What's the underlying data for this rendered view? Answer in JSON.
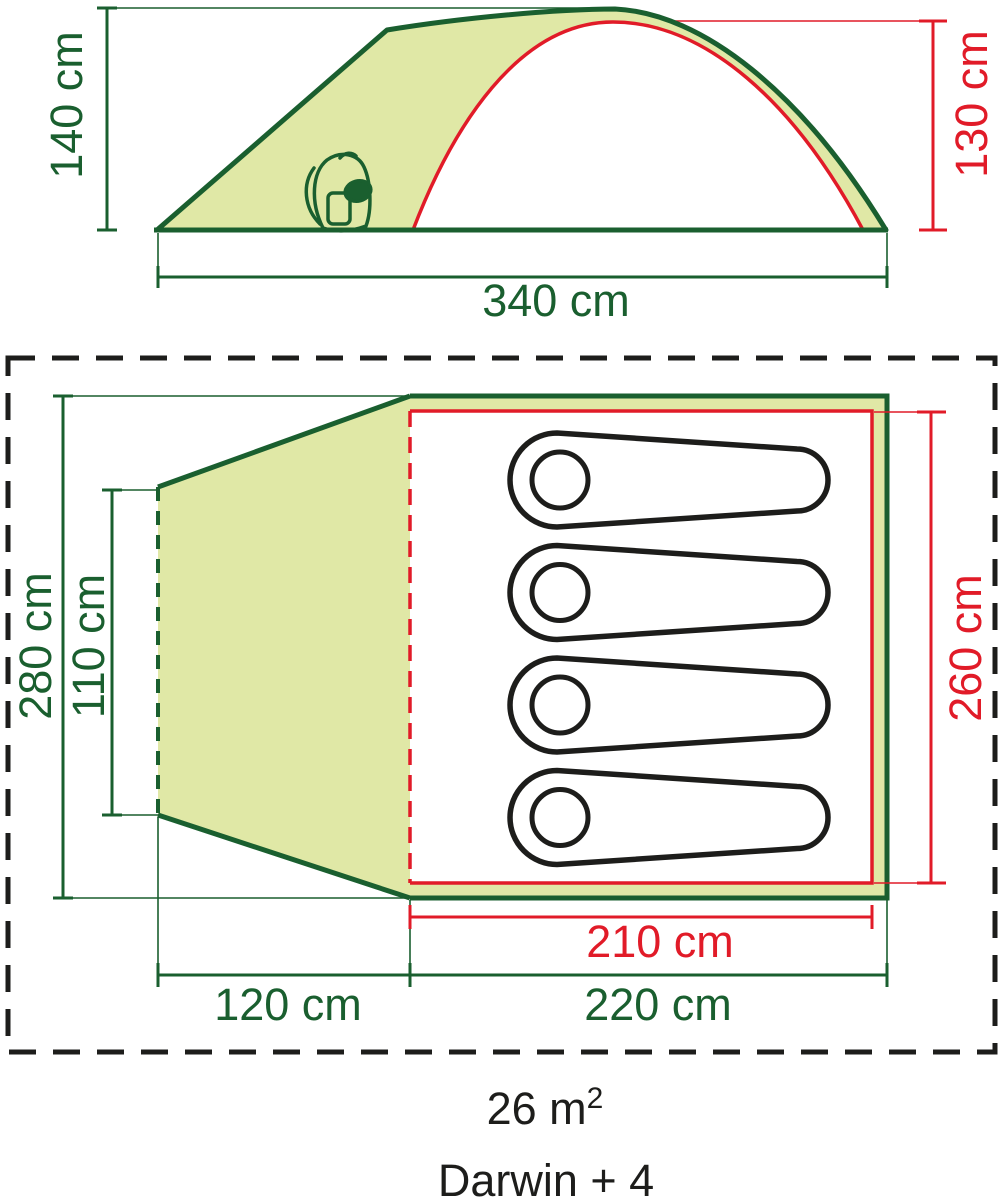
{
  "figure": {
    "title_semantics": "tent dimension diagram",
    "side_view": {
      "peak_height_label": "140 cm",
      "inner_height_label": "130 cm",
      "length_label": "340 cm"
    },
    "floor_plan": {
      "total_depth_label": "280 cm",
      "vestibule_inner_depth_label": "110 cm",
      "inner_tent_depth_label": "260 cm",
      "inner_tent_width_label": "210 cm",
      "bedroom_width_label": "220 cm",
      "vestibule_width_label": "120 cm",
      "sleeping_bag_count": 4
    },
    "footer": {
      "area_base": "26 m",
      "area_superscript": "2",
      "model_name": "Darwin + 4"
    },
    "colors": {
      "outline_green": "#1a5f2f",
      "accent_red": "#e11b28",
      "canvas_fill": "#e0e8a6",
      "text_black": "#1d1d1b"
    }
  }
}
